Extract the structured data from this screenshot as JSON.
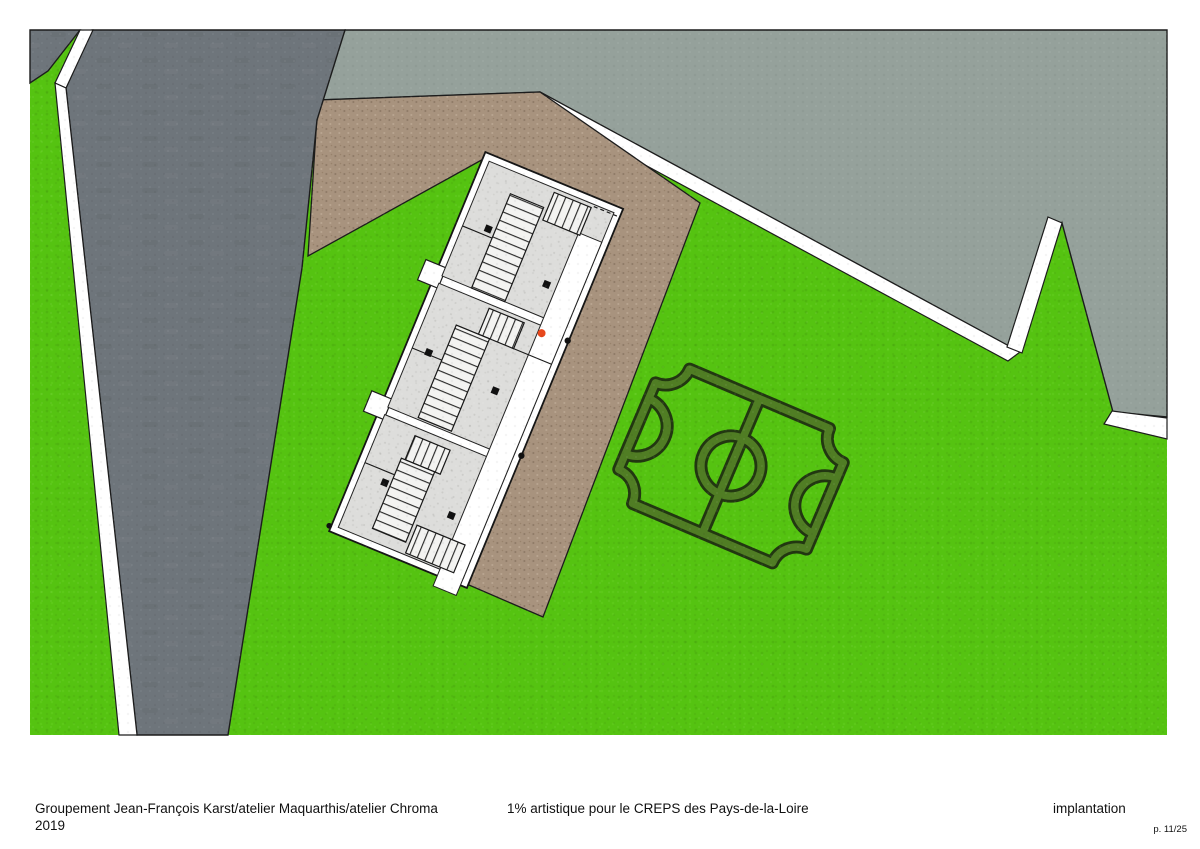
{
  "footer": {
    "left_line1": "Groupement Jean-François Karst/atelier Maquarthis/atelier Chroma",
    "left_line2": "2019",
    "center": "1% artistique pour le CREPS des Pays-de-la-Loire",
    "right": "implantation",
    "page_number": "p. 11/25"
  },
  "plan": {
    "features": [
      "grass-lawn",
      "asphalt-road",
      "white-footpaths",
      "upper-gray-terrace",
      "gravel-path",
      "building-complex-three-blocks",
      "staircases",
      "circulation-walkway",
      "entrance-red-marker",
      "hedge-soccer-pitch"
    ]
  },
  "colors": {
    "page_bg": "#ffffff",
    "grass": "#55c311",
    "road": "#6e757b",
    "sage": "#95a19b",
    "path_brown": "#a8937e",
    "white_path": "#ffffff",
    "outline": "#1c1c1c",
    "building_floor": "#dddddb",
    "stair_fill": "#f3f3f1",
    "hedge_dark": "#223711",
    "hedge_green": "#507d24",
    "marker_red": "#e8481c",
    "marker_black": "#111111",
    "footer_text": "#111111"
  }
}
